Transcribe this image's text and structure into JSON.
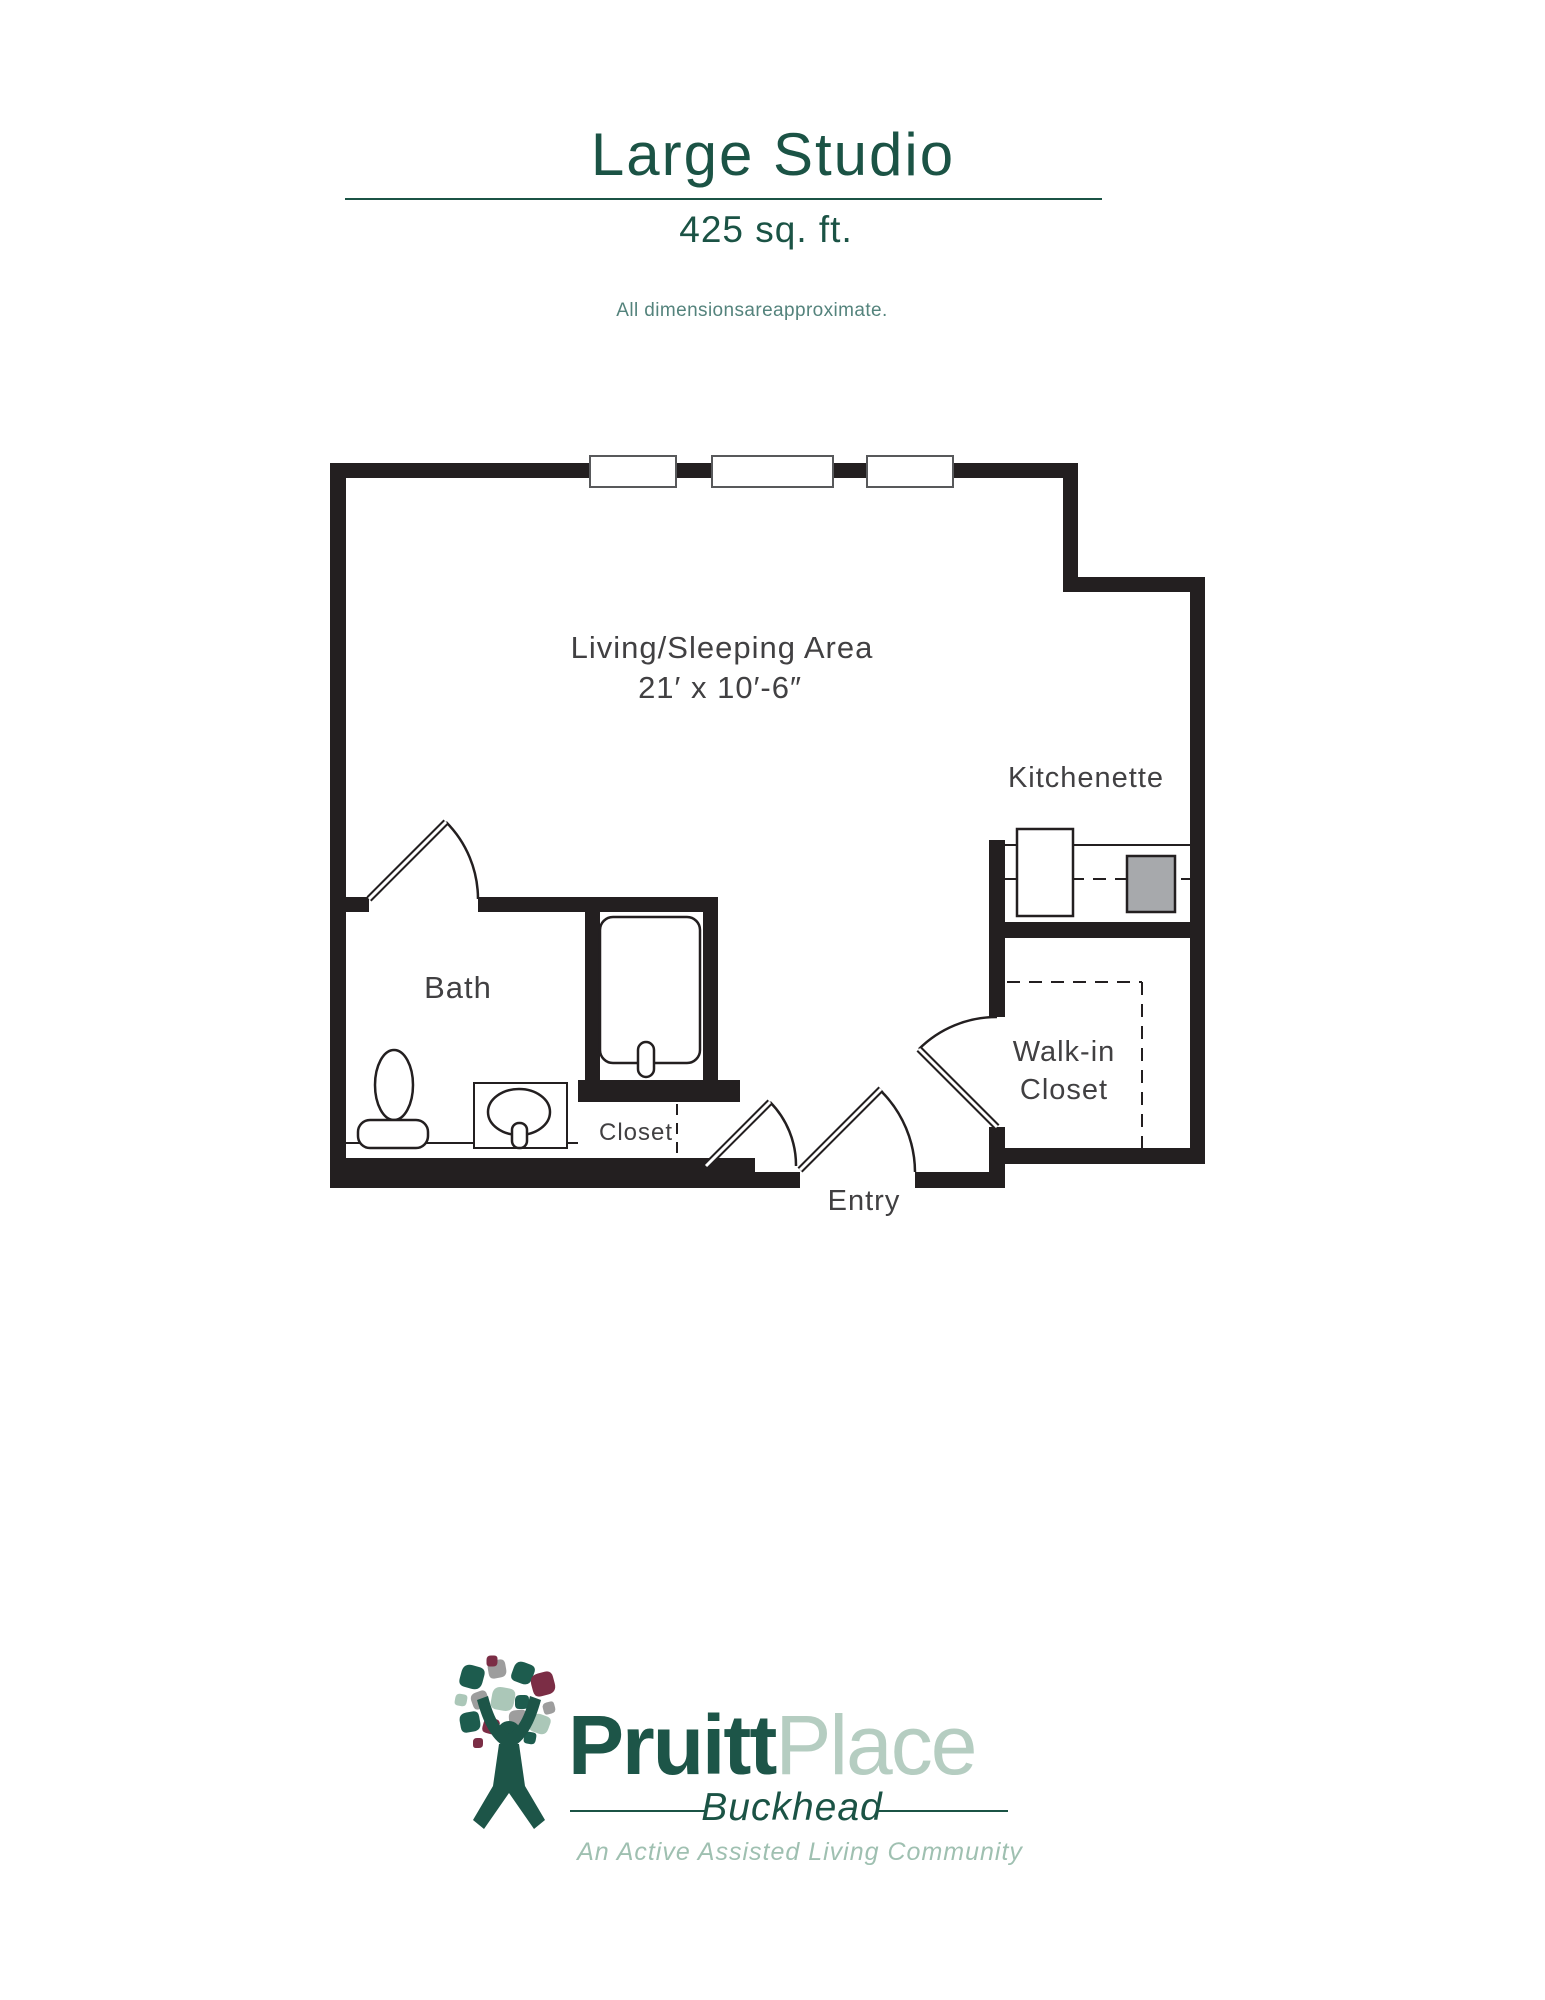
{
  "page": {
    "title": "Large Studio",
    "subtitle": "425 sq. ft.",
    "disclaimer": "All dimensionsareapproximate."
  },
  "plan": {
    "living_area_label": "Living/Sleeping Area",
    "living_area_dims": "21′ x 10′-6″",
    "kitchenette_label": "Kitchenette",
    "bath_label": "Bath",
    "walk_in_closet_line1": "Walk-in",
    "walk_in_closet_line2": "Closet",
    "closet_label": "Closet",
    "entry_label": "Entry"
  },
  "logo": {
    "brand_first": "Pruitt",
    "brand_second": "Place",
    "location": "Buckhead",
    "tagline": "An Active Assisted Living Community"
  },
  "colors": {
    "brand_dark_green": "#1b5345",
    "brand_sage": "#b5cdc1",
    "wall_black": "#231f20",
    "label_gray": "#414042",
    "appliance_gray": "#a7a9ac",
    "leaf_maroon": "#7b2d45",
    "leaf_gray": "#9d9d9d"
  }
}
